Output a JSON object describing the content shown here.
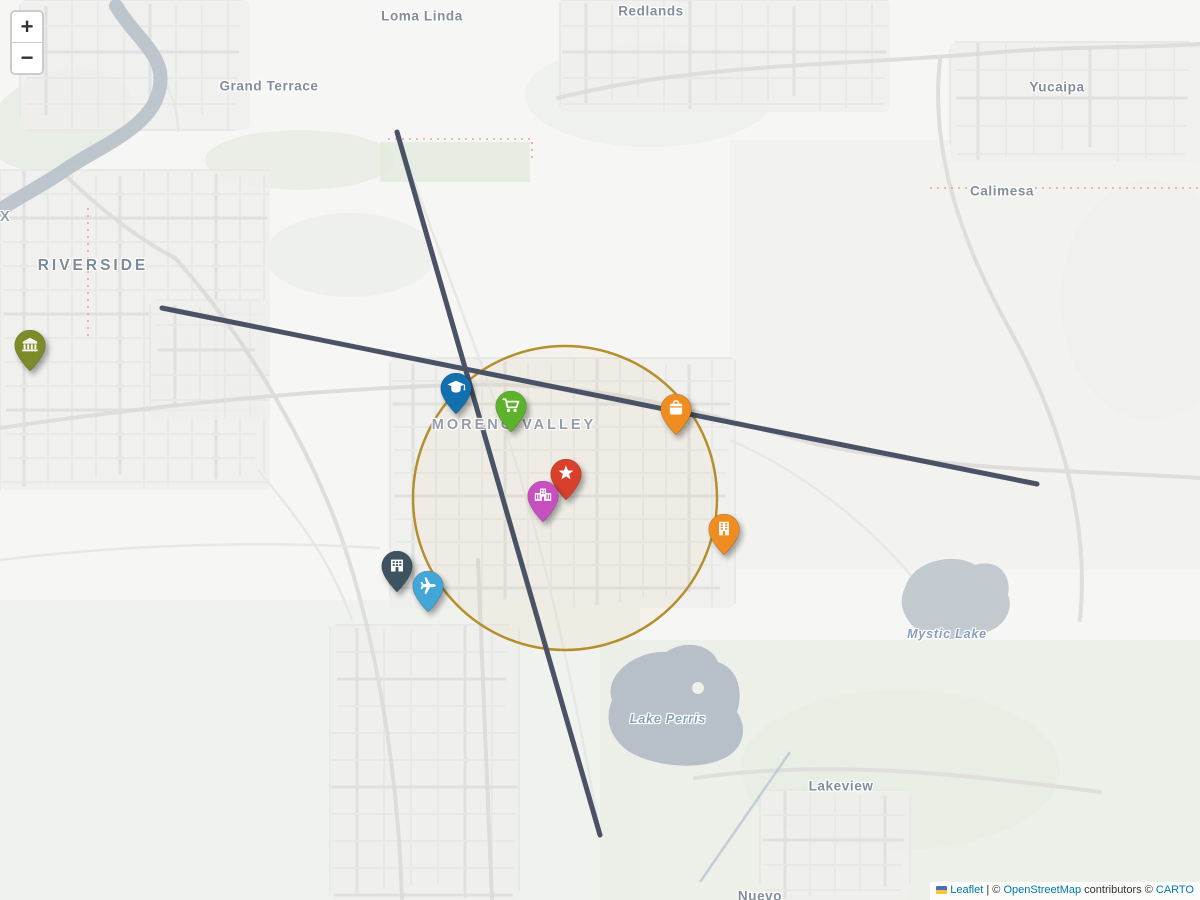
{
  "map": {
    "zoom_control": {
      "zoom_in_label": "+",
      "zoom_out_label": "−"
    },
    "attribution": {
      "leaflet_link": "Leaflet",
      "separator": "|",
      "osm_copyright": "©",
      "osm_link": "OpenStreetMap",
      "osm_suffix": "contributors",
      "carto_copyright": "©",
      "carto_link": "CARTO"
    },
    "place_labels": [
      {
        "name": "loma-linda",
        "text": "Loma Linda",
        "kind": "city",
        "x": 422,
        "y": 16
      },
      {
        "name": "redlands",
        "text": "Redlands",
        "kind": "city",
        "x": 651,
        "y": 11
      },
      {
        "name": "grand-terrace",
        "text": "Grand Terrace",
        "kind": "city",
        "x": 269,
        "y": 86
      },
      {
        "name": "yucaipa",
        "text": "Yucaipa",
        "kind": "city",
        "x": 1057,
        "y": 87
      },
      {
        "name": "calimesa",
        "text": "Calimesa",
        "kind": "city",
        "x": 1002,
        "y": 191
      },
      {
        "name": "rubidoux-partial",
        "text": "RUBIDOUX",
        "kind": "city-caps-light",
        "x": -38,
        "y": 217
      },
      {
        "name": "riverside",
        "text": "RIVERSIDE",
        "kind": "city-caps",
        "x": 93,
        "y": 266
      },
      {
        "name": "moreno-valley",
        "text": "MORENO VALLEY",
        "kind": "city-caps-light",
        "x": 514,
        "y": 425
      },
      {
        "name": "mystic-lake",
        "text": "Mystic Lake",
        "kind": "water",
        "x": 947,
        "y": 634
      },
      {
        "name": "lake-perris",
        "text": "Lake Perris",
        "kind": "water",
        "x": 668,
        "y": 719
      },
      {
        "name": "lakeview",
        "text": "Lakeview",
        "kind": "city",
        "x": 841,
        "y": 786
      },
      {
        "name": "nuevo",
        "text": "Nuevo",
        "kind": "city",
        "x": 760,
        "y": 896
      }
    ],
    "markers": [
      {
        "name": "bank",
        "icon": "bank-icon",
        "color": "#7d8b29",
        "x": 30,
        "y": 371
      },
      {
        "name": "university",
        "icon": "graduation-cap-icon",
        "color": "#1270ae",
        "x": 456,
        "y": 414
      },
      {
        "name": "supermarket",
        "icon": "shopping-cart-icon",
        "color": "#5cb32b",
        "x": 511,
        "y": 432
      },
      {
        "name": "store",
        "icon": "shopping-bag-icon",
        "color": "#ef8d20",
        "x": 676,
        "y": 435
      },
      {
        "name": "star-place",
        "icon": "star-icon",
        "color": "#d8402c",
        "x": 566,
        "y": 500
      },
      {
        "name": "hospital",
        "icon": "hospital-icon",
        "color": "#c84fc0",
        "x": 543,
        "y": 522
      },
      {
        "name": "office-building",
        "icon": "office-building-icon",
        "color": "#ef8d20",
        "x": 724,
        "y": 555
      },
      {
        "name": "company",
        "icon": "building-icon",
        "color": "#3e535f",
        "x": 397,
        "y": 592
      },
      {
        "name": "airport",
        "icon": "airplane-icon",
        "color": "#42a6d9",
        "x": 428,
        "y": 612
      }
    ],
    "overlays": {
      "radius_circle": {
        "cx": 565,
        "cy": 498,
        "r": 152,
        "stroke": "#b58f2e"
      },
      "route_lines": [
        {
          "name": "route-line-east-west",
          "x1": 162,
          "y1": 308,
          "x2": 1037,
          "y2": 484,
          "stroke": "#4a5266"
        },
        {
          "name": "route-line-north-south",
          "x1": 397,
          "y1": 132,
          "x2": 600,
          "y2": 835,
          "stroke": "#4a5266"
        }
      ]
    }
  }
}
